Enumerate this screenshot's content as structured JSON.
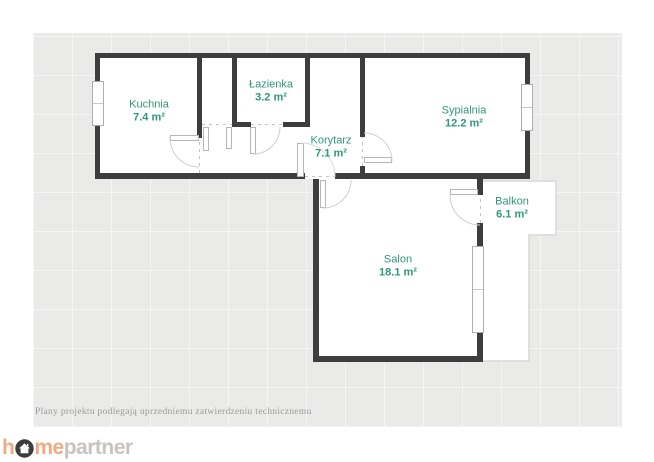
{
  "plan": {
    "colors": {
      "board_background": "#eaeae9",
      "wall": "#3d3d3d",
      "room_label": "#2e9878",
      "hairline": "#c9c9c9"
    },
    "rooms": [
      {
        "id": "kuchnia",
        "name": "Kuchnia",
        "area": "7.4 m²"
      },
      {
        "id": "lazienka",
        "name": "Łazienka",
        "area": "3.2 m²"
      },
      {
        "id": "korytarz",
        "name": "Korytarz",
        "area": "7.1 m²"
      },
      {
        "id": "sypialnia",
        "name": "Sypialnia",
        "area": "12.2 m²"
      },
      {
        "id": "salon",
        "name": "Salon",
        "area": "18.1 m²"
      },
      {
        "id": "balkon",
        "name": "Balkon",
        "area": "6.1 m²"
      }
    ],
    "disclaimer": "Plany projektu podlegają uprzedniemu zatwierdzeniu technicznemu"
  },
  "footer": {
    "logo": {
      "prefix": "h",
      "icon": "house-in-circle",
      "middle": "me",
      "suffix": "partner",
      "accent_color": "#eeaa84",
      "muted_color": "#c7c3c0",
      "icon_color": "#3d3d3d"
    }
  }
}
